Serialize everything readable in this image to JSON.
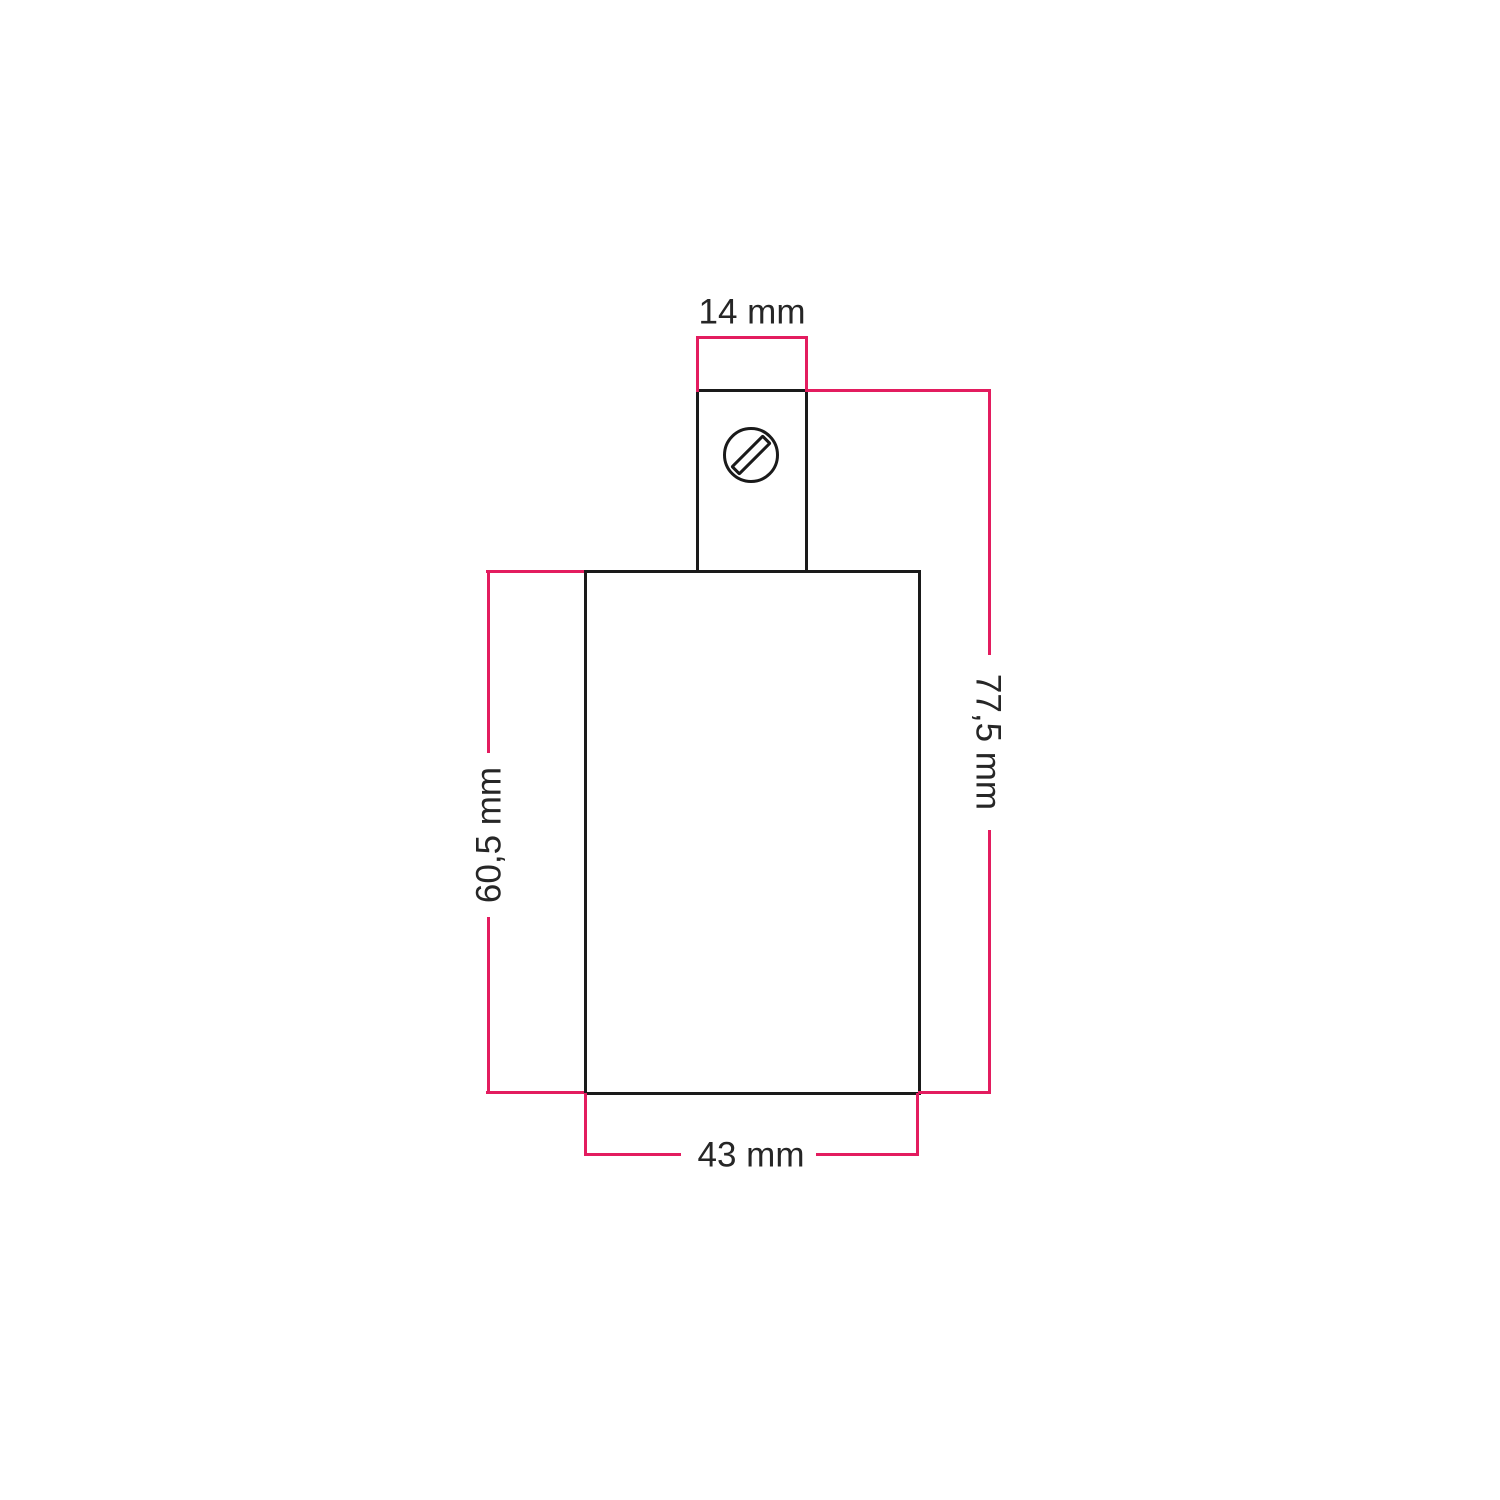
{
  "colors": {
    "dimension_lines": "#e31c5f",
    "outline": "#1a1a1a",
    "label_text": "#262626",
    "background": "#ffffff"
  },
  "labels": {
    "top_width": "14 mm",
    "total_height": "77,5 mm",
    "body_height": "60,5 mm",
    "body_width": "43 mm"
  },
  "values_mm": {
    "top_width": 14,
    "total_height": 77.5,
    "body_height": 60.5,
    "body_width": 43
  },
  "icons": {
    "screw": "slotted-screw-icon"
  }
}
